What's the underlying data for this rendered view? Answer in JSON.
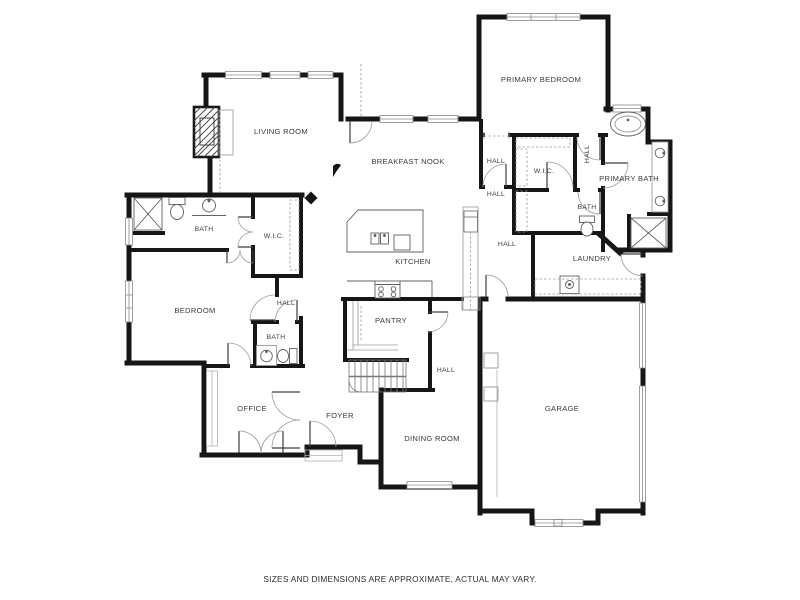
{
  "meta": {
    "type": "floor-plan",
    "wall_color": "#161616",
    "label_color": "#3a3a3a",
    "background_color": "#ffffff"
  },
  "labels": {
    "living_room": "LIVING ROOM",
    "breakfast_nook": "BREAKFAST NOOK",
    "primary_bedroom": "PRIMARY BEDROOM",
    "primary_bath": "PRIMARY BATH",
    "wic_primary": "W.I.C.",
    "hall_primary": "HALL",
    "bath_primary_hall": "BATH",
    "laundry": "LAUNDRY",
    "hall_vestibule": "HALL",
    "hall_mid": "HALL",
    "hall_mudroom": "HALL",
    "kitchen": "KITCHEN",
    "pantry": "PANTRY",
    "bath_main": "BATH",
    "wic_bedroom": "W.I.C.",
    "bedroom": "BEDROOM",
    "hall_bedroom": "HALL",
    "bath_hall": "BATH",
    "office": "OFFICE",
    "foyer": "FOYER",
    "hall_rear": "HALL",
    "dining_room": "DINING ROOM",
    "garage": "GARAGE"
  },
  "footer": {
    "disclaimer": "SIZES AND DIMENSIONS ARE APPROXIMATE, ACTUAL MAY VARY."
  }
}
